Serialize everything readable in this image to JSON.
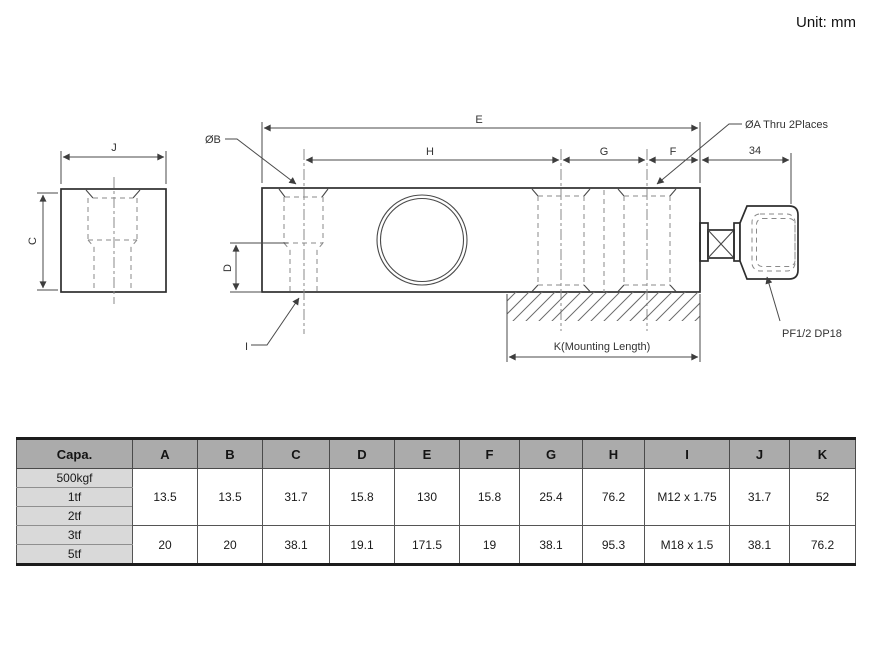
{
  "unit_note": "Unit: mm",
  "diagram": {
    "dims": {
      "j": "J",
      "c": "C",
      "e": "E",
      "h": "H",
      "g": "G",
      "f": "F",
      "n34": "34",
      "d": "D",
      "k": "K(Mounting Length)"
    },
    "callouts": {
      "ob": "ØB",
      "i": "I",
      "oa": "ØA Thru 2Places",
      "pf": "PF1/2 DP18"
    }
  },
  "table": {
    "headers": [
      "Capa.",
      "A",
      "B",
      "C",
      "D",
      "E",
      "F",
      "G",
      "H",
      "I",
      "J",
      "K"
    ],
    "groups": [
      {
        "capacities": [
          "500kgf",
          "1tf",
          "2tf"
        ],
        "values": [
          "13.5",
          "13.5",
          "31.7",
          "15.8",
          "130",
          "15.8",
          "25.4",
          "76.2",
          "M12 x 1.75",
          "31.7",
          "52"
        ]
      },
      {
        "capacities": [
          "3tf",
          "5tf"
        ],
        "values": [
          "20",
          "20",
          "38.1",
          "19.1",
          "171.5",
          "19",
          "38.1",
          "95.3",
          "M18 x 1.5",
          "38.1",
          "76.2"
        ]
      }
    ]
  },
  "colors": {
    "header_bg": "#ababab",
    "capacity_bg": "#d9d9d9",
    "outline": "#2e2e2e",
    "dim_line": "#4a4a4a",
    "hidden_line": "#8a8a8a"
  }
}
